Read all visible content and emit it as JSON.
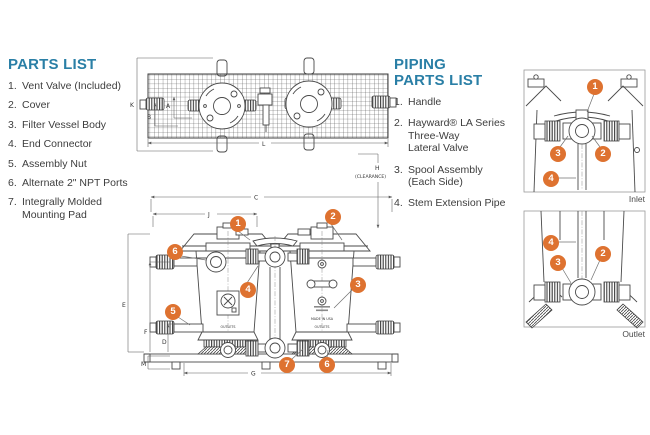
{
  "colors": {
    "accent_orange": "#de7230",
    "heading_blue": "#2a7fa6",
    "line": "#4a4a4a"
  },
  "parts_list": {
    "title": "PARTS LIST",
    "items": [
      {
        "num": "1.",
        "label": "Vent Valve (Included)"
      },
      {
        "num": "2.",
        "label": "Cover"
      },
      {
        "num": "3.",
        "label": "Filter Vessel Body"
      },
      {
        "num": "4.",
        "label": "End Connector"
      },
      {
        "num": "5.",
        "label": "Assembly Nut"
      },
      {
        "num": "6.",
        "label": "Alternate 2\" NPT Ports"
      },
      {
        "num": "7.",
        "label": "Integrally Molded\nMounting Pad"
      }
    ]
  },
  "piping_parts_list": {
    "title": "PIPING\nPARTS LIST",
    "items": [
      {
        "num": "1.",
        "label": "Handle"
      },
      {
        "num": "2.",
        "label": "Hayward® LA Series\nThree-Way\nLateral Valve"
      },
      {
        "num": "3.",
        "label": "Spool Assembly\n(Each Side)"
      },
      {
        "num": "4.",
        "label": "Stem Extension Pipe"
      }
    ]
  },
  "dimensions": {
    "k": "K",
    "b": "B",
    "a": "A",
    "l": "L",
    "c": "C",
    "j": "J",
    "h": "H",
    "h_note": "(CLEARANCE)",
    "e": "E",
    "f": "F",
    "d": "D",
    "m": "M",
    "g": "G"
  },
  "callouts": {
    "front": [
      "1",
      "2",
      "3",
      "4",
      "5",
      "6",
      "7",
      "6"
    ],
    "inlet": [
      "1",
      "2",
      "3",
      "4"
    ],
    "outlet": [
      "4",
      "3",
      "2"
    ]
  },
  "views": {
    "inlet_label": "Inlet",
    "outlet_label": "Outlet"
  },
  "drawing_text": {
    "outlets_left": "OUTLETS",
    "outlets_right": "OUTLETS",
    "made_in_usa": "MADE IN USA"
  }
}
